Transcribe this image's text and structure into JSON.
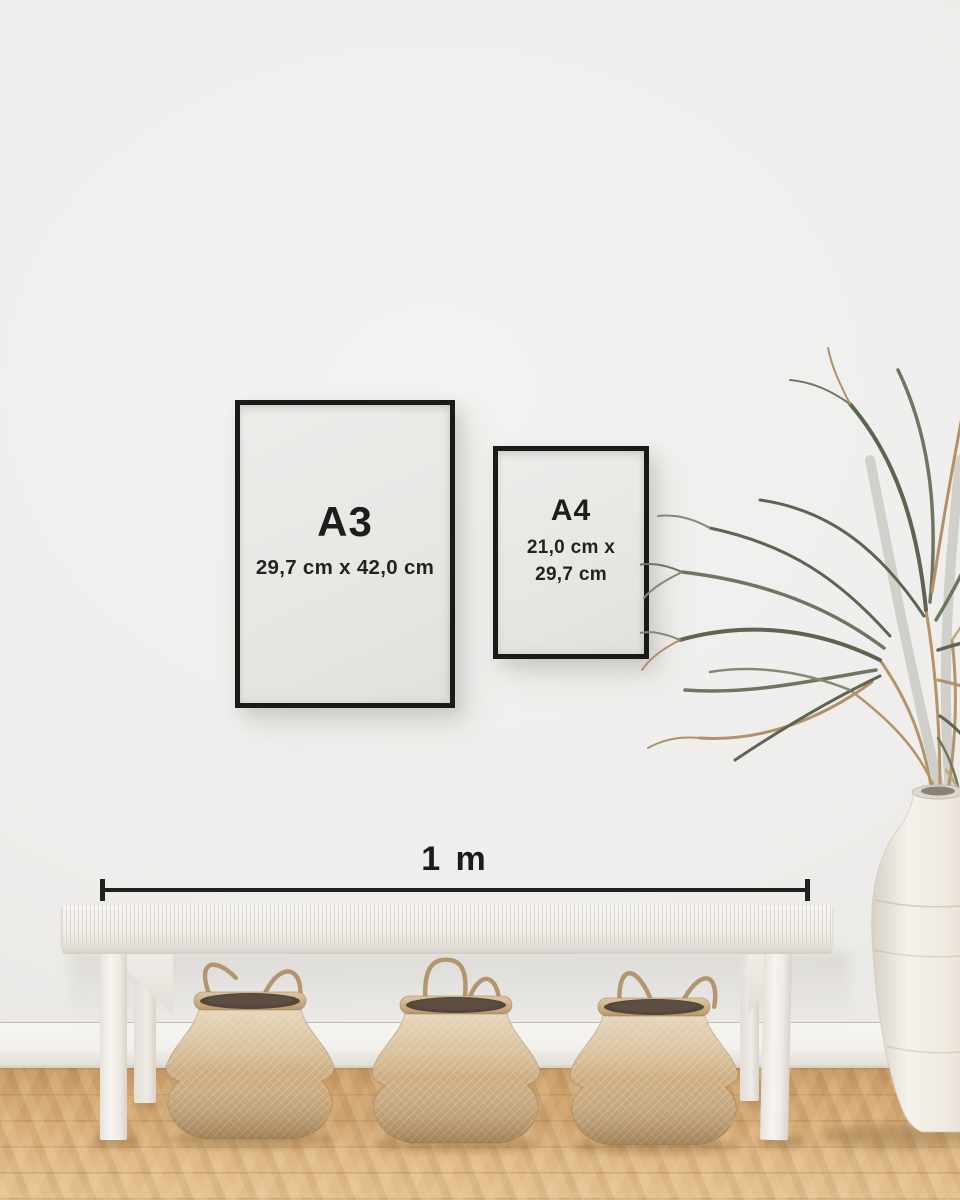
{
  "frames": {
    "a3": {
      "label": "A3",
      "dimensions": "29,7 cm x 42,0 cm"
    },
    "a4": {
      "label": "A4",
      "dimensions_line1": "21,0 cm x",
      "dimensions_line2": "29,7 cm"
    }
  },
  "scale": {
    "label": "1 m"
  },
  "scene": {
    "objects": [
      "black A3 picture frame on wall",
      "black A4 picture frame on wall",
      "horizontal 1 m scale bar with end ticks",
      "white woven-top bench",
      "three tan seagrass belly baskets under bench",
      "dried palm plant",
      "white ceramic floor vase",
      "oak wood floor",
      "white baseboard",
      "light warm-gray wall"
    ],
    "colors": {
      "frame_black": "#1a1a19",
      "poster_paper": "#e8e6e3",
      "wall": "#efeeec",
      "baseboard": "#f3f1ed",
      "floor_wood": "#d8ad78",
      "bench_white": "#f3f1ee",
      "basket_tan": "#cdb28b",
      "basket_opening": "#53463a",
      "plant_green": "#5c6550",
      "plant_dried": "#b2916a",
      "vase_white": "#f1eee8",
      "text": "#1c1c1b"
    }
  }
}
